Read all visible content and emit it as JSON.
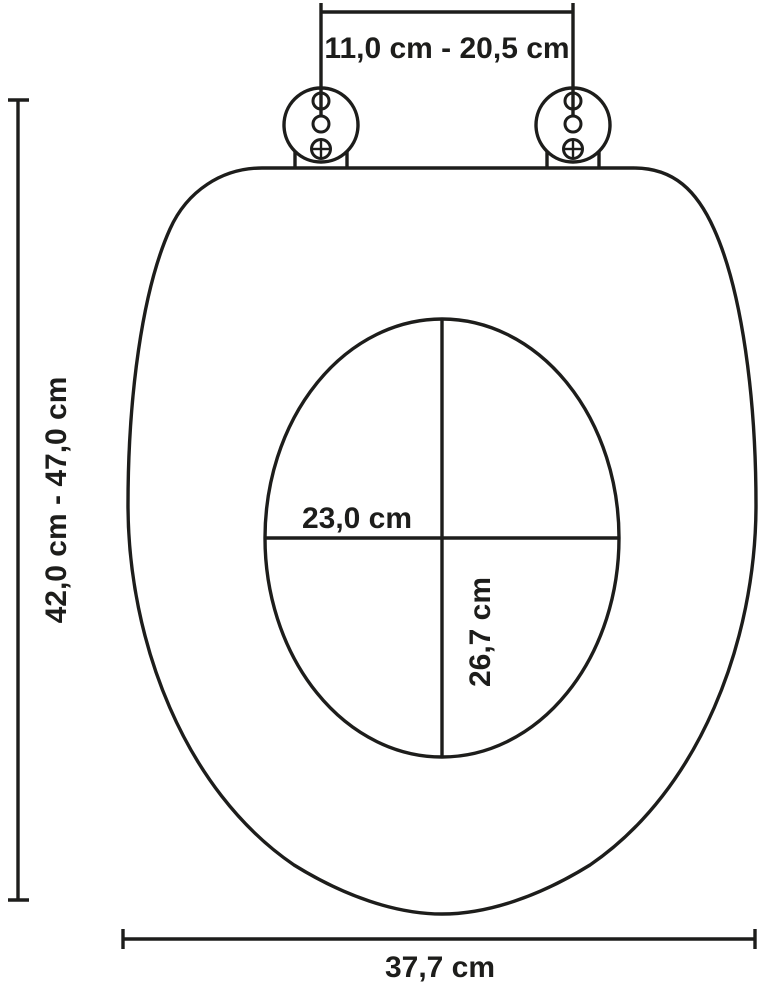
{
  "diagram": {
    "type": "technical-dimension-drawing",
    "subject": "toilet-seat",
    "background_color": "#ffffff",
    "line_color": "#1d1d1b",
    "labels": {
      "hinge_distance": "11,0 cm - 20,5 cm",
      "overall_length": "42,0 cm - 47,0 cm",
      "inner_width": "23,0 cm",
      "inner_depth": "26,7 cm",
      "seat_width": "37,7 cm"
    }
  }
}
